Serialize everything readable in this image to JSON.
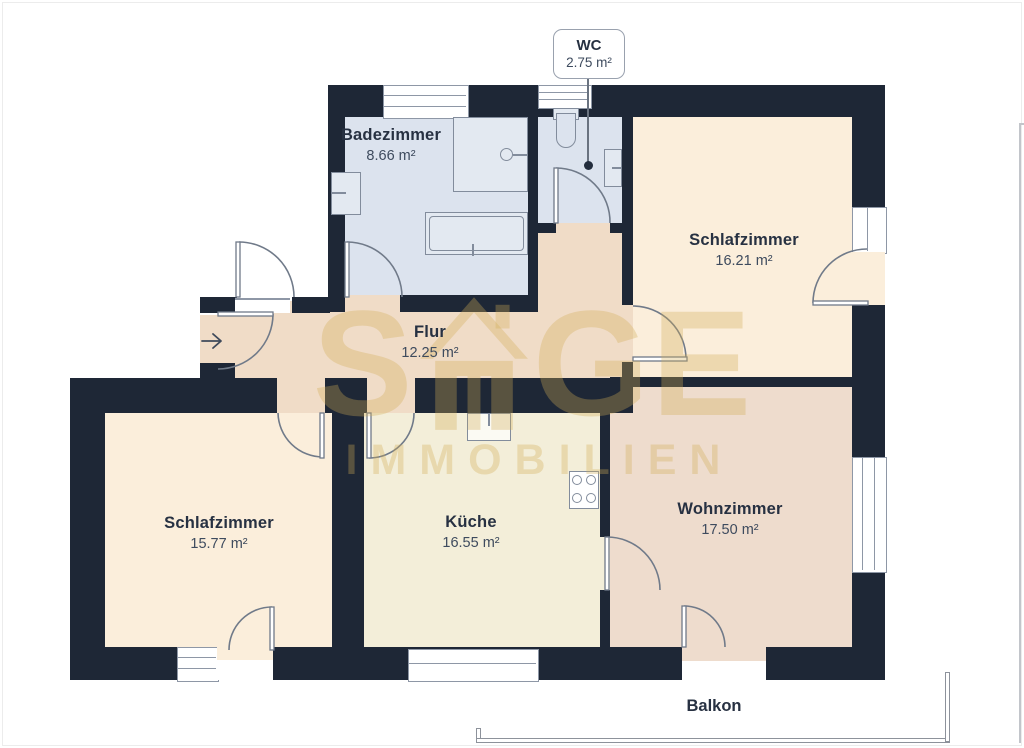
{
  "rooms": {
    "badezimmer": {
      "name": "Badezimmer",
      "area": "8.66 m²"
    },
    "wc": {
      "name": "WC",
      "area": "2.75 m²"
    },
    "schlafzimmer_top": {
      "name": "Schlafzimmer",
      "area": "16.21 m²"
    },
    "flur": {
      "name": "Flur",
      "area": "12.25 m²"
    },
    "schlafzimmer_bottom": {
      "name": "Schlafzimmer",
      "area": "15.77 m²"
    },
    "kueche": {
      "name": "Küche",
      "area": "16.55 m²"
    },
    "wohnzimmer": {
      "name": "Wohnzimmer",
      "area": "17.50 m²"
    },
    "balkon": {
      "name": "Balkon"
    }
  },
  "watermark": {
    "word_start": "S",
    "word_end": "GE",
    "subtitle": "IMMOBILIEN"
  },
  "colors": {
    "wall": "#1e2736",
    "floor-bath": "#dce3ee",
    "floor-bedroom": "#fbeedb",
    "floor-hall": "#f0dcc7",
    "floor-kitchen": "#f3eed9",
    "floor-living": "#eedccd",
    "text": "#273142",
    "door-line": "#707a89",
    "watermark-gold": "#d2ac54"
  }
}
